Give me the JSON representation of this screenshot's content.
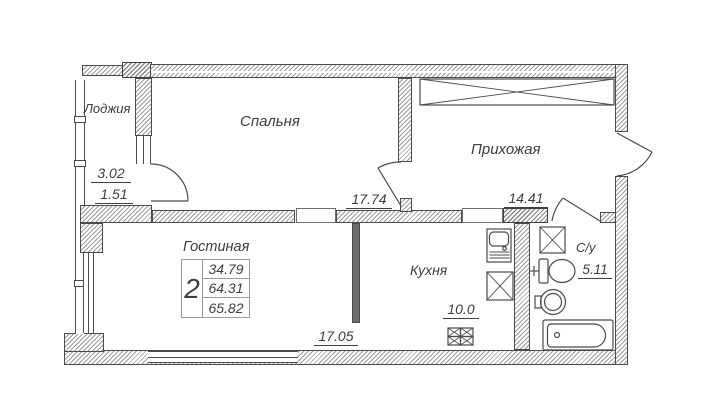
{
  "rooms": {
    "loggia": {
      "name": "Лоджия",
      "area_full": "3.02",
      "area_half": "1.51"
    },
    "bedroom": {
      "name": "Спальня",
      "area": "17.74"
    },
    "hallway": {
      "name": "Прихожая",
      "area": "14.41"
    },
    "living": {
      "name": "Гостиная",
      "area": "17.05"
    },
    "kitchen": {
      "name": "Кухня",
      "area": "10.0"
    },
    "bathroom": {
      "name": "С/у",
      "area": "5.11"
    }
  },
  "summary": {
    "rooms_count": "2",
    "living_area": "34.79",
    "area_without_loggia": "64.31",
    "total_area": "65.82"
  },
  "colors": {
    "line": "#4b4b4b",
    "text": "#3d3d3d",
    "hatch": "#9c9c9c",
    "background": "#ffffff"
  }
}
